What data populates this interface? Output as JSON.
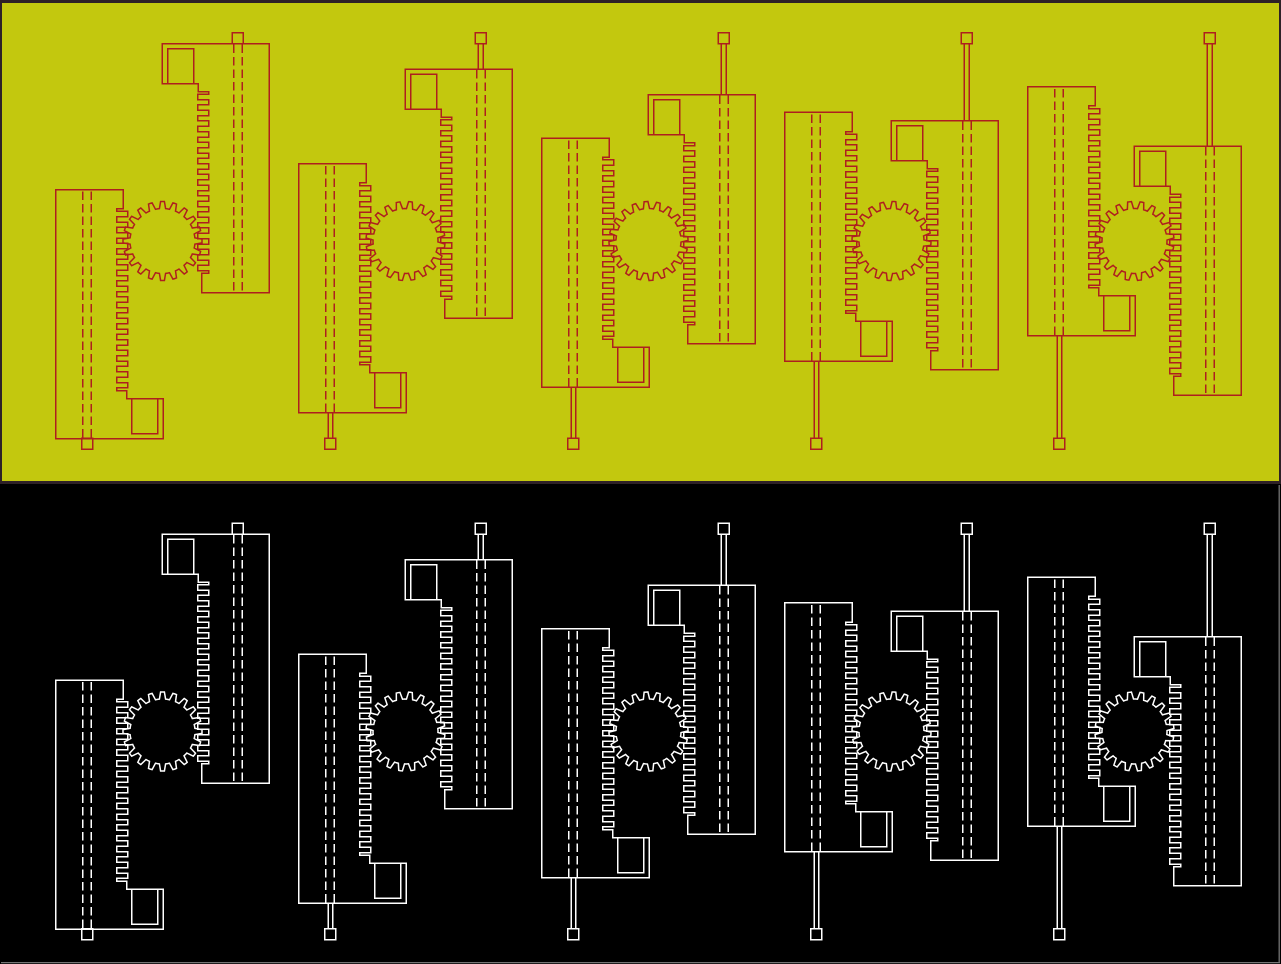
{
  "scene": {
    "width": 1281,
    "height": 964,
    "frame_color": "#2e2127",
    "edge_highlight_color": "#747474",
    "description": "CAD render of a rack-and-pinion mechanism, five motion phases, duplicated in two viewports"
  },
  "bands": [
    {
      "id": "top",
      "background": "#c3c80e",
      "stroke": "#ae1f1f",
      "x": 2,
      "y": 3,
      "width": 1277,
      "height": 478,
      "drawing_offset_y": 0
    },
    {
      "id": "bottom",
      "background": "#000000",
      "stroke": "#ffffff",
      "x": 0,
      "y": 484,
      "width": 1281,
      "height": 480,
      "drawing_offset_y": 490.5
    }
  ],
  "mechanism": {
    "unit_count": 5,
    "unit_spacing_x": 243,
    "rack_travel_step_y": 25.7,
    "stroke_width": 1.5,
    "gear": {
      "cx": 162.5,
      "cy": 241,
      "teeth": 20,
      "tip_radius": 39.5,
      "root_radius": 32.5,
      "base_angle_deg": 0,
      "step_angle_deg": 43.2,
      "tip_arc_deg": 5.5,
      "root_arc_deg": 7
    },
    "assembly": {
      "body": {
        "left": 201.8,
        "top": 43.5,
        "right": 269.3,
        "bottom": 292.5
      },
      "flange": {
        "left": 162,
        "bottom": 83.5,
        "notch_x": 198.3,
        "notch_y": 91.5
      },
      "window": {
        "x": 167.5,
        "y": 48.5,
        "width": 26,
        "height": 35
      },
      "rack_teeth": {
        "root_x": 208.5,
        "tip_x": 197.5,
        "start_y": 91.5,
        "count": 17,
        "period": 10.7,
        "tip_span": 5.3
      },
      "center_dashes": {
        "x1": 233.9,
        "x2": 242.1,
        "pattern": "8.5 4"
      },
      "rod_cap": {
        "x": 232.2,
        "y": 32.7,
        "width": 11,
        "height": 11
      },
      "rod": {
        "x": 235.4,
        "width": 4.6,
        "top": 43.7
      }
    }
  }
}
